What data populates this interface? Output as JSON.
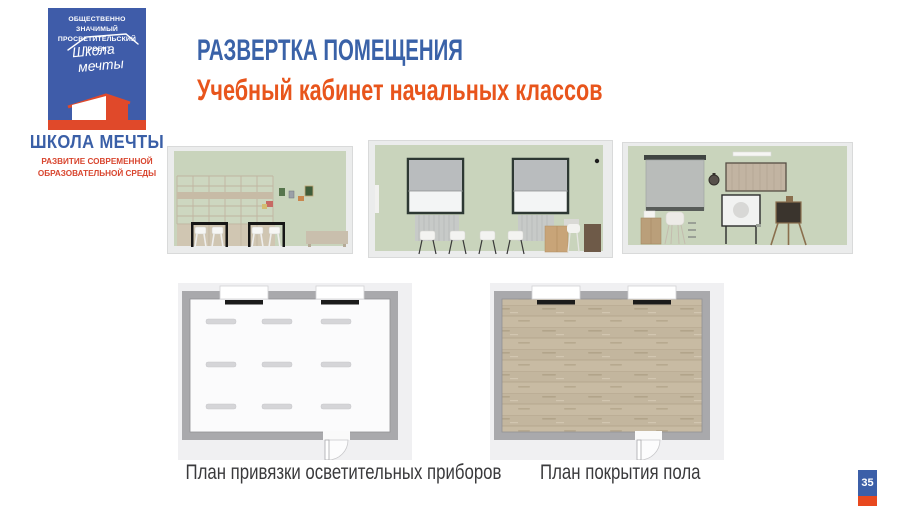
{
  "slide": {
    "page_number": "35"
  },
  "logo": {
    "project_line1": "ОБЩЕСТВЕННО ЗНАЧИМЫЙ",
    "project_line2": "ПРОСВЕТИТЕЛЬСКИЙ ПРОЕКТ",
    "script_line1": "Школа",
    "script_line2": "мечты",
    "brand_name": "ШКОЛА МЕЧТЫ",
    "tagline_line1": "РАЗВИТИЕ СОВРЕМЕННОЙ",
    "tagline_line2": "ОБРАЗОВАТЕЛЬНОЙ СРЕДЫ"
  },
  "header": {
    "title": "РАЗВЕРТКА ПОМЕЩЕНИЯ",
    "subtitle": "Учебный кабинет начальных классов"
  },
  "plans": {
    "lighting_caption": "План привязки осветительных приборов",
    "flooring_caption": "План покрытия пола"
  },
  "colors": {
    "brand_blue": "#3f5ca9",
    "title_blue": "#3a62a8",
    "accent_orange": "#e8551c",
    "logo_red": "#e0492a",
    "wall_green": "#c9d4bc",
    "plan_wall_gray": "#a9a9ac",
    "wood_floor": "#c8bba3"
  }
}
